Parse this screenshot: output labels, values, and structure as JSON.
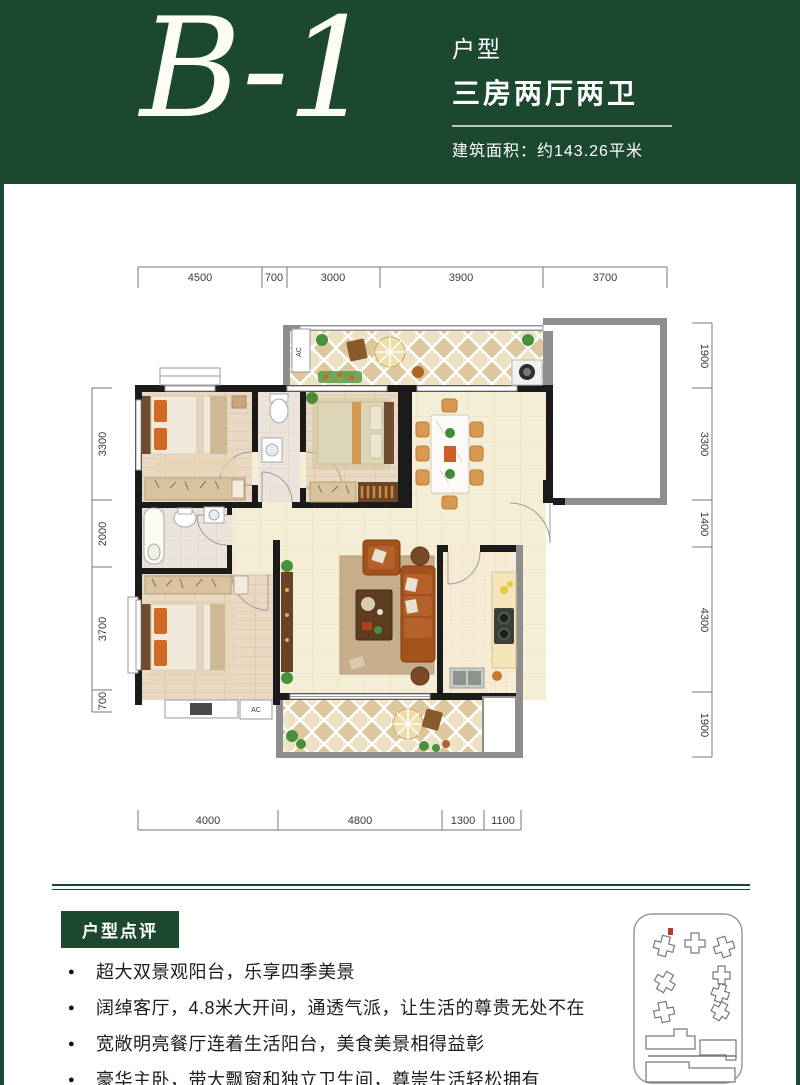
{
  "header": {
    "unit_code": "B-1",
    "type_label": "户型",
    "type_value": "三房两厅两卫",
    "area_text": "建筑面积：约143.26平米"
  },
  "floorplan": {
    "dims_top": [
      "4500",
      "700",
      "3000",
      "3900",
      "3700"
    ],
    "dims_left": [
      "3300",
      "2000",
      "3700",
      "700"
    ],
    "dims_right": [
      "1900",
      "3300",
      "1400",
      "4300",
      "1900"
    ],
    "dims_bottom": [
      "4000",
      "4800",
      "1300",
      "1100"
    ],
    "ac_label_balcony": "AC",
    "ac_label_platform": "AC"
  },
  "review": {
    "title": "户型点评",
    "bullets": [
      "超大双景观阳台，乐享四季美景",
      "阔绰客厅，4.8米大开间，通透气派，让生活的尊贵无处不在",
      "宽敞明亮餐厅连着生活阳台，美食美景相得益彰",
      "豪华主卧，带大飘窗和独立卫生间，尊崇生活轻松拥有"
    ]
  },
  "colors": {
    "brand_green": "#1c4830",
    "wall_black": "#1b1b1b",
    "wall_gray": "#8e8e8e",
    "marker_red": "#b03a2e"
  }
}
